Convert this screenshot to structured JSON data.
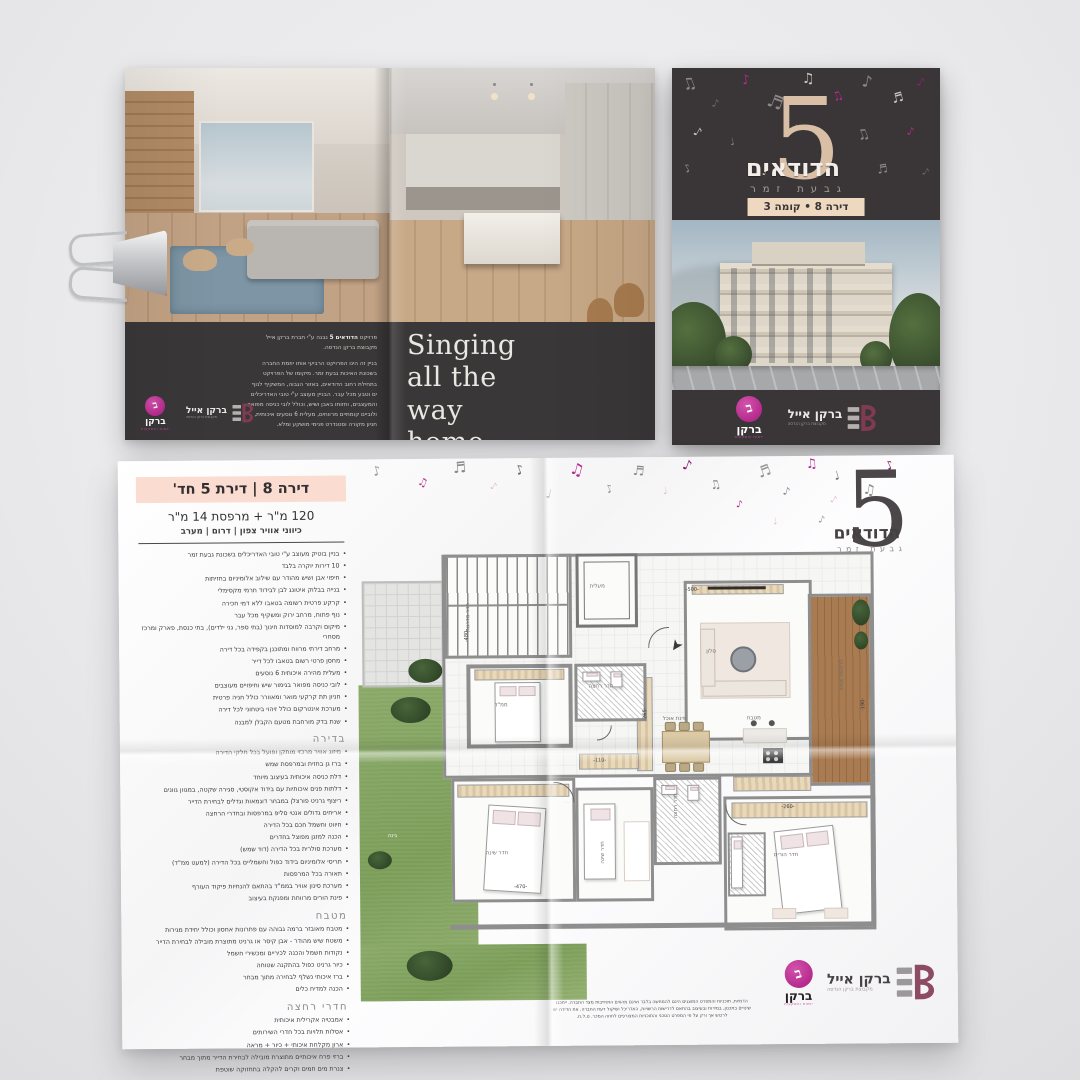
{
  "brand": {
    "number": "5",
    "name": "הדודאים",
    "subtitle": "גבעת זמר"
  },
  "cover": {
    "badge": "דירה 8 • קומה 3"
  },
  "logos": {
    "barkan_eyal": {
      "name": "ברקן אייל",
      "tagline": "מקבוצת ברקן הנדסה"
    },
    "barkan": {
      "name": "ברקן",
      "tagline": "יזמות והשקעות"
    }
  },
  "openBrochure": {
    "slogan": "Singing\nall the\nway\nhome",
    "about_intro_pre": "פרויקט ",
    "about_intro_bold": "הדודאים 5",
    "about_intro_post": " נבנה ע\"י חברת ברקן אייל מקבוצת ברקן הנדסה.",
    "about_body": "בניין זה הינו הפרויקט הרביעי אותו יוזמת החברה בשכונת האיכות גבעת זמר. מיקומו של הפרויקט בתחילת רחוב הדודאים, באזור הגבוה, המשקיף לנוף ים וטבע מכל עבר. הבניין מעוצב ע\"י טובי האדריכלים והמעצבים, וחזותו באבן ושיש, וכולל לובי כניסה מפואר ולוביים קומתיים מרווחים, מעלית 6 נוסעים איכותית, חניון מקורה וסטנדרט פנימי מושקע ומלא."
  },
  "sheet": {
    "title": "דירה 8 | דירת 5 חד'",
    "area": "120 מ\"ר + מרפסת 14 מ\"ר",
    "directions": "כיווני אוויר צפון | דרום | מערב",
    "features": [
      "בניין בוטיק מעוצב ע\"י טובי האדריכלים בשכונת גבעת זמר",
      "10 דירות יוקרה בלבד",
      "חיפוי אבן ושיש מהודר עם שילוב אלומיניום בחזיתות",
      "בנייה בבלוק איטונג לבן לבידוד תרמי מקסימלי",
      "קרקע פרטית רשומה בטאבו ללא דמי חכירה",
      "נוף פתוח, מרחב ירוק ומשקיף מכל עבר",
      "מיקום וקרבה למוסדות חינוך (בתי ספר, גני ילדים), בתי כנסת, פארק ומרכז מסחרי",
      "מרחב דירתי מרווח ומתוכנן בקפידה בכל דירה",
      "מחסן פרטי רשום בטאבו לכל דייר",
      "מעלית מהירה איכותית 6 נוסעים",
      "לובי כניסה מפואר בגימור שיש וחיפויים מעוצבים",
      "חניון תת קרקעי מואר ומאוורר כולל חניה פרטית",
      "מערכת אינטרקום כולל זיהוי ביטחוני לכל דירה",
      "שנת בדק מורחבת מטעם הקבלן למבנה"
    ],
    "sections": [
      {
        "title": "בדירה",
        "items": [
          "מיזוג אוויר מרכזי מותקן ופועל בכל חלקי הדירה",
          "ברז גן בחזית ובמרפסת שמש",
          "דלת כניסה איכותית בעיצוב מיוחד",
          "דלתות פנים איכותיות עם בידוד אקוסטי, סגירה שקטה, במגוון גוונים",
          "ריצוף גרניט פורצלן במבחר דוגמאות וגדלים לבחירת הדייר",
          "אריחים גדולים אנטי סליפ במרפסות ובחדרי הרחצה",
          "חיווט וחשמל חכם בכל הדירה",
          "הכנה למזגן מפוצל בחדרים",
          "מערכת סולרית בכל הדירה (דוד שמש)",
          "תריסי אלומיניום בידוד כפול וחשמליים בכל הדירה (למעט ממ\"ד)",
          "תאורה בכל המרפסות",
          "מערכת סינון אוויר בממ\"ד בהתאם להנחיות פיקוד העורף",
          "פינת הורים מרווחת ומפנקת בעיצוב"
        ]
      },
      {
        "title": "מטבח",
        "items": [
          "מטבח מאובזר ברמה גבוהה עם פתרונות אחסון וכולל יחידת מגירות",
          "משטח שיש מהודר - אבן קיסר או גרניט מתוצרת מובילה לבחירת הדייר",
          "נקודות חשמל והכנה לכיריים ומכשירי חשמל",
          "כיור גרניט כפול בהתקנה שטוחה",
          "ברז איכותי נשלף לבחירה מתוך מבחר",
          "הכנה למדיח כלים"
        ]
      },
      {
        "title": "חדרי רחצה",
        "items": [
          "אמבטיה אקרילית איכותית",
          "אסלות תלויות בכל חדרי השירותים",
          "ארון מקלחת איכותי + כיור + מראה",
          "ברזי פרח איכותיים מתוצרת מובילה לבחירת הדייר מתוך מבחר",
          "צנרת מים חמים וקרים להקלה בתחזוקה שוטפת"
        ]
      }
    ],
    "disclaimer": "הדמיות, תוכניות והמפרט המוצגים הינם להמחשה בלבד ואינם מהווים התחייבות מצד החברה. ייתכנו שינויים בתכנון, במידות ובעיצוב בהתאם לדרישות הרשויות, האדריכל ושיקול דעת החברה. את הדירה יש לרכוש אך ורק על פי המפרט הטכני והתוכניות המצורפים לחוזה המכר. ט.ל.ח."
  },
  "plan": {
    "labels": [
      {
        "x": 234,
        "y": 30,
        "t": "מעלית",
        "r": 0
      },
      {
        "x": 98,
        "y": 60,
        "t": "חדר מדרגות",
        "r": -90
      },
      {
        "x": 350,
        "y": 96,
        "t": "סלון",
        "r": 0
      },
      {
        "x": 306,
        "y": 163,
        "t": "פינת אוכל",
        "r": 0
      },
      {
        "x": 390,
        "y": 163,
        "t": "מטבח",
        "r": 0
      },
      {
        "x": 470,
        "y": 120,
        "t": "מרפסת שמש",
        "r": -90
      },
      {
        "x": 138,
        "y": 148,
        "t": "ממ\"ד",
        "r": 0
      },
      {
        "x": 232,
        "y": 130,
        "t": "חדר רחצה",
        "r": 0
      },
      {
        "x": 128,
        "y": 296,
        "t": "חדר שינה",
        "r": 0
      },
      {
        "x": 234,
        "y": 296,
        "t": "חדר שינה",
        "r": -90
      },
      {
        "x": 416,
        "y": 300,
        "t": "חדר הורים",
        "r": 0
      },
      {
        "x": 306,
        "y": 250,
        "t": "חדר רחצה",
        "r": -90
      },
      {
        "x": 30,
        "y": 278,
        "t": "גינה",
        "r": 0,
        "c": "#f2f5ec"
      }
    ],
    "dims": [
      {
        "x": 330,
        "y": 34,
        "t": "-500-",
        "r": 0
      },
      {
        "x": 104,
        "y": 78,
        "t": "-480-",
        "r": -90
      },
      {
        "x": 236,
        "y": 204,
        "t": "-110-",
        "r": 0
      },
      {
        "x": 282,
        "y": 158,
        "t": "-265-",
        "r": -90
      },
      {
        "x": 424,
        "y": 252,
        "t": "-260-",
        "r": 0
      },
      {
        "x": 156,
        "y": 330,
        "t": "-470-",
        "r": 0
      },
      {
        "x": 500,
        "y": 150,
        "t": "-190-",
        "r": -90
      }
    ]
  },
  "decor": {
    "cover_notes": [
      {
        "x": 10,
        "y": 8,
        "s": 16,
        "r": -20,
        "c": "#8d8887",
        "g": "♫"
      },
      {
        "x": 40,
        "y": 30,
        "s": 11,
        "r": 15,
        "c": "#6d6867",
        "g": "♪"
      },
      {
        "x": 70,
        "y": 6,
        "s": 13,
        "r": -10,
        "c": "#b62a8e",
        "g": "♪"
      },
      {
        "x": 95,
        "y": 26,
        "s": 18,
        "r": 20,
        "c": "#8d8887",
        "g": "♬"
      },
      {
        "x": 130,
        "y": 4,
        "s": 14,
        "r": 0,
        "c": "#c9c5c3",
        "g": "♫"
      },
      {
        "x": 160,
        "y": 22,
        "s": 12,
        "r": -25,
        "c": "#b62a8e",
        "g": "♫"
      },
      {
        "x": 190,
        "y": 6,
        "s": 16,
        "r": 10,
        "c": "#8d8887",
        "g": "♪"
      },
      {
        "x": 220,
        "y": 24,
        "s": 13,
        "r": -15,
        "c": "#c9c5c3",
        "g": "♬"
      },
      {
        "x": 245,
        "y": 8,
        "s": 12,
        "r": 20,
        "c": "#8e1f6e",
        "g": "♪"
      },
      {
        "x": 22,
        "y": 58,
        "s": 12,
        "r": 30,
        "c": "#c9c5c3",
        "g": "♪"
      },
      {
        "x": 58,
        "y": 70,
        "s": 10,
        "r": -15,
        "c": "#8d8887",
        "g": "♩"
      },
      {
        "x": 120,
        "y": 55,
        "s": 11,
        "r": 10,
        "c": "#6d6867",
        "g": "♪"
      },
      {
        "x": 185,
        "y": 60,
        "s": 14,
        "r": -20,
        "c": "#8d8887",
        "g": "♫"
      },
      {
        "x": 235,
        "y": 58,
        "s": 11,
        "r": 15,
        "c": "#b62a8e",
        "g": "♪"
      },
      {
        "x": 12,
        "y": 95,
        "s": 11,
        "r": -30,
        "c": "#8d8887",
        "g": "♪"
      },
      {
        "x": 90,
        "y": 100,
        "s": 10,
        "r": 20,
        "c": "#c9c5c3",
        "g": "♩"
      },
      {
        "x": 205,
        "y": 95,
        "s": 12,
        "r": -10,
        "c": "#8d8887",
        "g": "♬"
      },
      {
        "x": 250,
        "y": 100,
        "s": 10,
        "r": 25,
        "c": "#6d6867",
        "g": "♪"
      }
    ],
    "sheet_notes": [
      {
        "x": 255,
        "y": 6,
        "s": 13,
        "r": -15,
        "c": "#9a9596",
        "g": "♪"
      },
      {
        "x": 300,
        "y": 18,
        "s": 11,
        "r": 20,
        "c": "#b62a8e",
        "g": "♫"
      },
      {
        "x": 335,
        "y": 2,
        "s": 15,
        "r": -5,
        "c": "#8d8887",
        "g": "♬"
      },
      {
        "x": 372,
        "y": 24,
        "s": 10,
        "r": 25,
        "c": "#e3bcd2",
        "g": "♪"
      },
      {
        "x": 398,
        "y": 6,
        "s": 13,
        "r": -20,
        "c": "#6f6a6b",
        "g": "♪"
      },
      {
        "x": 428,
        "y": 30,
        "s": 12,
        "r": 10,
        "c": "#8d8887",
        "g": "♩"
      },
      {
        "x": 452,
        "y": 4,
        "s": 16,
        "r": 15,
        "c": "#b62a8e",
        "g": "♫"
      },
      {
        "x": 488,
        "y": 26,
        "s": 11,
        "r": -25,
        "c": "#9a9596",
        "g": "♪"
      },
      {
        "x": 515,
        "y": 8,
        "s": 13,
        "r": 5,
        "c": "#8d8887",
        "g": "♬"
      },
      {
        "x": 545,
        "y": 30,
        "s": 10,
        "r": -10,
        "c": "#e3bcd2",
        "g": "♩"
      },
      {
        "x": 565,
        "y": 2,
        "s": 14,
        "r": 20,
        "c": "#8e1f6e",
        "g": "♪"
      },
      {
        "x": 592,
        "y": 22,
        "s": 12,
        "r": -15,
        "c": "#8d8887",
        "g": "♫"
      },
      {
        "x": 618,
        "y": 44,
        "s": 10,
        "r": 10,
        "c": "#b62a8e",
        "g": "♪"
      },
      {
        "x": 640,
        "y": 8,
        "s": 15,
        "r": -20,
        "c": "#9a9596",
        "g": "♬"
      },
      {
        "x": 665,
        "y": 30,
        "s": 11,
        "r": 15,
        "c": "#8d8887",
        "g": "♪"
      },
      {
        "x": 688,
        "y": 2,
        "s": 13,
        "r": -5,
        "c": "#b62a8e",
        "g": "♫"
      },
      {
        "x": 712,
        "y": 40,
        "s": 10,
        "r": 25,
        "c": "#e3bcd2",
        "g": "♪"
      },
      {
        "x": 716,
        "y": 14,
        "s": 12,
        "r": -15,
        "c": "#6f6a6b",
        "g": "♩"
      },
      {
        "x": 745,
        "y": 28,
        "s": 14,
        "r": 10,
        "c": "#8d8887",
        "g": "♫"
      },
      {
        "x": 768,
        "y": 4,
        "s": 12,
        "r": -25,
        "c": "#8e1f6e",
        "g": "♪"
      },
      {
        "x": 700,
        "y": 60,
        "s": 10,
        "r": 15,
        "c": "#9a9596",
        "g": "♪"
      },
      {
        "x": 655,
        "y": 62,
        "s": 9,
        "r": -10,
        "c": "#e3bcd2",
        "g": "♩"
      }
    ]
  },
  "colors": {
    "accent_magenta": "#b62a8e",
    "beige": "#d8bfa5",
    "peach": "#fadcd0",
    "dark_panel": "#3a3637",
    "maroon_logo": "#7e3b51"
  }
}
